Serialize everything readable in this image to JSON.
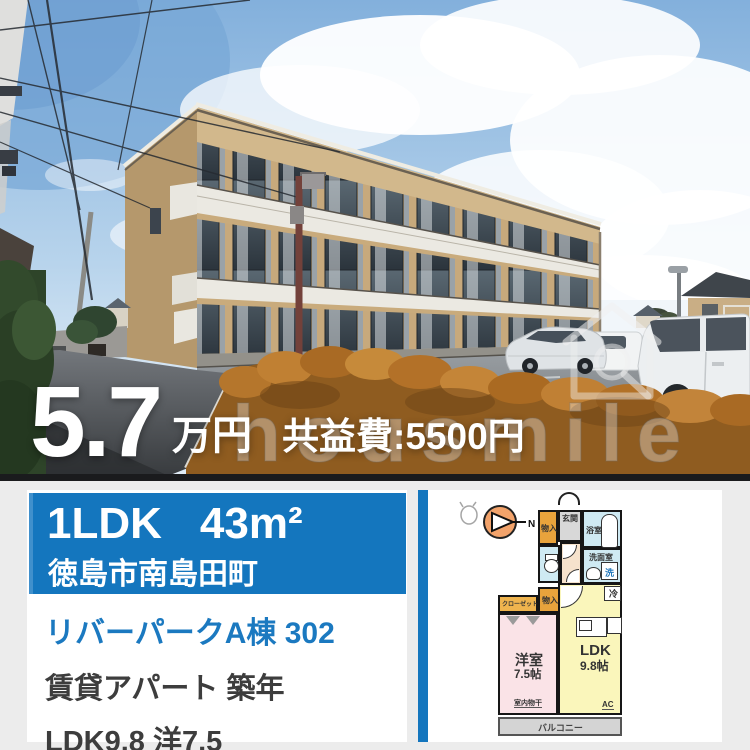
{
  "colors": {
    "banner_blue": "#1476be",
    "stripe_blue": "#1476be",
    "link_blue": "#1b79c0",
    "price_text": "#ffffff",
    "plan_storage_orange": "#e8a33c",
    "plan_closet_orange": "#efb44e",
    "plan_western_pink": "#fae3e7",
    "plan_ldk_yellow": "#faf6bb",
    "plan_wet_lightblue": "#cfeaf3",
    "plan_balcony_gray": "#d4d4d4"
  },
  "photo": {
    "watermark": "housmile"
  },
  "price": {
    "amount": "5.7",
    "unit": "万円",
    "fee": "共益費:5500円"
  },
  "banner": {
    "layout": "1LDK",
    "size": "43m²",
    "location": "徳島市南島田町"
  },
  "details": {
    "title": "リバーパークA棟 302",
    "line1": "賃貸アパート 築年",
    "line2": "LDK9.8 洋7.5"
  },
  "floorplan": {
    "compass": "N",
    "labels": {
      "genkan": "玄関",
      "storage": "物入",
      "bath": "浴室",
      "washroom": "洗面室",
      "washer": "洗",
      "fridge": "冷",
      "closet": "クローゼット",
      "western_name": "洋室",
      "western_size": "7.5帖",
      "ldk_name": "LDK",
      "ldk_size": "9.8帖",
      "laundry": "室内物干",
      "ac": "AC",
      "balcony": "バルコニー"
    }
  }
}
